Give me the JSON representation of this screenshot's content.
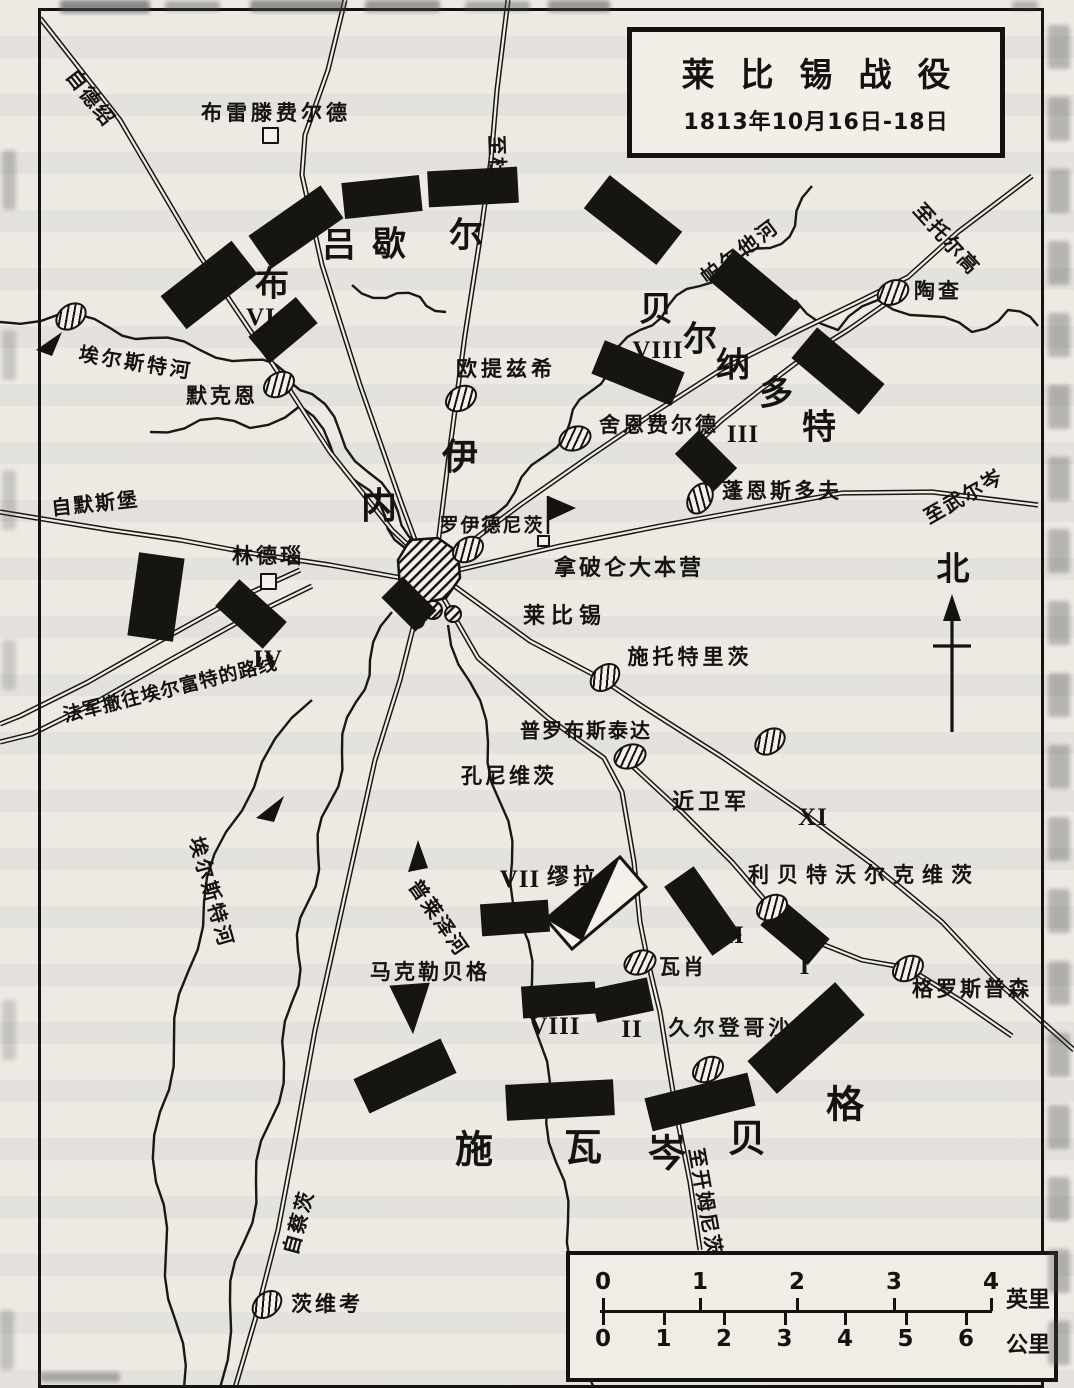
{
  "title": {
    "main": "莱比锡战役",
    "sub": "1813年10月16日-18日"
  },
  "compass": {
    "north_label": "北"
  },
  "scale": {
    "miles": {
      "ticks": [
        "0",
        "1",
        "2",
        "3",
        "4"
      ],
      "unit": "英里"
    },
    "km": {
      "ticks": [
        "0",
        "1",
        "2",
        "3",
        "4",
        "5",
        "6"
      ],
      "unit": "公里"
    }
  },
  "labels": [
    {
      "name": "breitenfeld",
      "text": "布雷滕费尔德",
      "x": 276,
      "y": 112,
      "size": 21,
      "ls": 4,
      "rot": 0
    },
    {
      "name": "eutritzsch",
      "text": "欧提兹希",
      "x": 506,
      "y": 368,
      "size": 21,
      "ls": 4,
      "rot": 0
    },
    {
      "name": "schoenefeld",
      "text": "舍恩费尔德",
      "x": 659,
      "y": 424,
      "size": 21,
      "ls": 3,
      "rot": 0
    },
    {
      "name": "taucha",
      "text": "陶查",
      "x": 938,
      "y": 290,
      "size": 21,
      "ls": 3,
      "rot": 0
    },
    {
      "name": "paunsdorf",
      "text": "蓬恩斯多夫",
      "x": 782,
      "y": 490,
      "size": 21,
      "ls": 3,
      "rot": 0
    },
    {
      "name": "reudnitz",
      "text": "罗伊德尼茨",
      "x": 492,
      "y": 524,
      "size": 19,
      "ls": 2,
      "rot": 0
    },
    {
      "name": "napoleon-hq",
      "text": "拿破仑大本营",
      "x": 629,
      "y": 566,
      "size": 22,
      "ls": 3,
      "rot": 0
    },
    {
      "name": "leipzig",
      "text": "莱比锡",
      "x": 565,
      "y": 614,
      "size": 22,
      "ls": 6,
      "rot": 0
    },
    {
      "name": "stoetteritz",
      "text": "施托特里茨",
      "x": 690,
      "y": 656,
      "size": 21,
      "ls": 4,
      "rot": 0
    },
    {
      "name": "probstheida",
      "text": "普罗布斯泰达",
      "x": 586,
      "y": 729,
      "size": 20,
      "ls": 2,
      "rot": 0
    },
    {
      "name": "connewitz",
      "text": "孔尼维茨",
      "x": 509,
      "y": 775,
      "size": 21,
      "ls": 3,
      "rot": 0
    },
    {
      "name": "guard",
      "text": "近卫军",
      "x": 711,
      "y": 800,
      "size": 22,
      "ls": 4,
      "rot": 0
    },
    {
      "name": "liebertwolkwitz",
      "text": "利贝特沃尔克维茨",
      "x": 864,
      "y": 874,
      "size": 21,
      "ls": 8,
      "rot": 0
    },
    {
      "name": "wachau",
      "text": "瓦肖",
      "x": 683,
      "y": 966,
      "size": 21,
      "ls": 3,
      "rot": 0
    },
    {
      "name": "gueldengossa",
      "text": "久尔登哥沙",
      "x": 731,
      "y": 1027,
      "size": 21,
      "ls": 4,
      "rot": 0
    },
    {
      "name": "grosspoesna",
      "text": "格罗斯普森",
      "x": 972,
      "y": 988,
      "size": 21,
      "ls": 3,
      "rot": 0
    },
    {
      "name": "markkleeberg",
      "text": "马克勒贝格",
      "x": 430,
      "y": 971,
      "size": 21,
      "ls": 3,
      "rot": 0
    },
    {
      "name": "zwenkau",
      "text": "茨维考",
      "x": 327,
      "y": 1303,
      "size": 21,
      "ls": 3,
      "rot": 0
    },
    {
      "name": "lindenau",
      "text": "林德瑙",
      "x": 268,
      "y": 555,
      "size": 21,
      "ls": 3,
      "rot": 0
    },
    {
      "name": "moeckern",
      "text": "默克恩",
      "x": 222,
      "y": 395,
      "size": 21,
      "ls": 3,
      "rot": 0
    },
    {
      "name": "murat",
      "text": "缪拉",
      "x": 573,
      "y": 875,
      "size": 22,
      "ls": 4,
      "rot": 0
    },
    {
      "name": "from-merseburg",
      "text": "自默斯堡",
      "x": 95,
      "y": 502,
      "size": 20,
      "ls": 2,
      "rot": -6
    },
    {
      "name": "retreat-route",
      "text": "法军撤往埃尔富特的路线",
      "x": 170,
      "y": 688,
      "size": 19,
      "ls": 1,
      "rot": -14
    },
    {
      "name": "from-dessau",
      "text": "自德绍",
      "x": 92,
      "y": 97,
      "size": 20,
      "ls": 2,
      "rot": 52
    },
    {
      "name": "to-dueben",
      "text": "至杜本",
      "x": 499,
      "y": 168,
      "size": 20,
      "ls": 2,
      "rot": 88
    },
    {
      "name": "to-torgau",
      "text": "至托尔高",
      "x": 948,
      "y": 238,
      "size": 20,
      "ls": 2,
      "rot": 48
    },
    {
      "name": "to-wurzen",
      "text": "至武尔岑",
      "x": 963,
      "y": 495,
      "size": 20,
      "ls": 2,
      "rot": -30
    },
    {
      "name": "to-chemnitz",
      "text": "至开姆尼茨",
      "x": 707,
      "y": 1202,
      "size": 20,
      "ls": 2,
      "rot": 80
    },
    {
      "name": "from-zeitz",
      "text": "自蔡茨",
      "x": 297,
      "y": 1222,
      "size": 20,
      "ls": 2,
      "rot": -75
    },
    {
      "name": "elster-river-west",
      "text": "埃尔斯特河",
      "x": 136,
      "y": 361,
      "size": 20,
      "ls": 3,
      "rot": 9
    },
    {
      "name": "elster-river-south",
      "text": "埃尔斯特河",
      "x": 213,
      "y": 892,
      "size": 20,
      "ls": 3,
      "rot": 74
    },
    {
      "name": "pleisse-river",
      "text": "普莱泽河",
      "x": 440,
      "y": 917,
      "size": 20,
      "ls": 2,
      "rot": 55
    },
    {
      "name": "parthe-river",
      "text": "帕尔他河",
      "x": 739,
      "y": 250,
      "size": 20,
      "ls": 3,
      "rot": -37
    }
  ],
  "commanders": [
    {
      "name": "bluecher",
      "size": 34,
      "chars": [
        {
          "t": "布",
          "x": 272,
          "y": 281
        },
        {
          "t": "吕",
          "x": 339,
          "y": 242
        },
        {
          "t": "歇",
          "x": 389,
          "y": 241
        },
        {
          "t": "尔",
          "x": 466,
          "y": 232
        }
      ]
    },
    {
      "name": "ney",
      "size": 36,
      "chars": [
        {
          "t": "内",
          "x": 379,
          "y": 503
        },
        {
          "t": "伊",
          "x": 460,
          "y": 454
        }
      ]
    },
    {
      "name": "bernadotte",
      "size": 34,
      "chars": [
        {
          "t": "贝",
          "x": 656,
          "y": 306
        },
        {
          "t": "尔",
          "x": 700,
          "y": 336
        },
        {
          "t": "纳",
          "x": 733,
          "y": 362
        },
        {
          "t": "多",
          "x": 776,
          "y": 390
        },
        {
          "t": "特",
          "x": 819,
          "y": 424
        }
      ]
    },
    {
      "name": "schwarzenberg",
      "size": 38,
      "chars": [
        {
          "t": "施",
          "x": 474,
          "y": 1146
        },
        {
          "t": "瓦",
          "x": 583,
          "y": 1144
        },
        {
          "t": "岑",
          "x": 667,
          "y": 1150
        },
        {
          "t": "贝",
          "x": 747,
          "y": 1135
        },
        {
          "t": "格",
          "x": 845,
          "y": 1101
        }
      ]
    }
  ],
  "corps": [
    {
      "num": "VI",
      "x": 261,
      "y": 318
    },
    {
      "num": "IV",
      "x": 268,
      "y": 660
    },
    {
      "num": "VIII",
      "x": 658,
      "y": 351
    },
    {
      "num": "III",
      "x": 743,
      "y": 435
    },
    {
      "num": "XI",
      "x": 813,
      "y": 818
    },
    {
      "num": "VII",
      "x": 520,
      "y": 880
    },
    {
      "num": "XI",
      "x": 730,
      "y": 936
    },
    {
      "num": "I",
      "x": 805,
      "y": 967
    },
    {
      "num": "VIII",
      "x": 555,
      "y": 1027
    },
    {
      "num": "II",
      "x": 632,
      "y": 1030
    }
  ],
  "units": [
    {
      "x": 296,
      "y": 227,
      "w": 88,
      "h": 40,
      "rot": -35
    },
    {
      "x": 382,
      "y": 197,
      "w": 78,
      "h": 36,
      "rot": -6
    },
    {
      "x": 473,
      "y": 187,
      "w": 90,
      "h": 36,
      "rot": -3
    },
    {
      "x": 209,
      "y": 285,
      "w": 90,
      "h": 42,
      "rot": -38
    },
    {
      "x": 283,
      "y": 330,
      "w": 62,
      "h": 34,
      "rot": -40
    },
    {
      "x": 633,
      "y": 220,
      "w": 92,
      "h": 42,
      "rot": 38
    },
    {
      "x": 755,
      "y": 293,
      "w": 88,
      "h": 40,
      "rot": 40
    },
    {
      "x": 838,
      "y": 371,
      "w": 88,
      "h": 40,
      "rot": 40
    },
    {
      "x": 638,
      "y": 373,
      "w": 86,
      "h": 36,
      "rot": 22
    },
    {
      "x": 706,
      "y": 461,
      "w": 54,
      "h": 34,
      "rot": 45
    },
    {
      "x": 409,
      "y": 604,
      "w": 48,
      "h": 30,
      "rot": 45
    },
    {
      "x": 156,
      "y": 597,
      "w": 46,
      "h": 84,
      "rot": 8
    },
    {
      "x": 251,
      "y": 614,
      "w": 64,
      "h": 36,
      "rot": 42
    },
    {
      "x": 515,
      "y": 918,
      "w": 68,
      "h": 32,
      "rot": -4
    },
    {
      "x": 703,
      "y": 911,
      "w": 84,
      "h": 36,
      "rot": 55
    },
    {
      "x": 795,
      "y": 932,
      "w": 62,
      "h": 34,
      "rot": 40
    },
    {
      "x": 559,
      "y": 1000,
      "w": 74,
      "h": 32,
      "rot": -4
    },
    {
      "x": 622,
      "y": 1000,
      "w": 58,
      "h": 34,
      "rot": -12
    },
    {
      "x": 806,
      "y": 1038,
      "w": 118,
      "h": 44,
      "rot": -42
    },
    {
      "x": 405,
      "y": 1076,
      "w": 96,
      "h": 38,
      "rot": -25
    },
    {
      "x": 560,
      "y": 1100,
      "w": 108,
      "h": 36,
      "rot": -3
    },
    {
      "x": 700,
      "y": 1102,
      "w": 106,
      "h": 34,
      "rot": -14
    },
    {
      "x": 412,
      "y": 1008,
      "w": 44,
      "h": 52,
      "rot": -10,
      "shape": "tri"
    }
  ],
  "towns": [
    {
      "name": "breitenfeld-town-icon",
      "x": 277,
      "y": 138,
      "type": "building"
    },
    {
      "name": "eutritzsch-town-icon",
      "x": 459,
      "y": 397,
      "rot": -30
    },
    {
      "name": "schoenefeld-town-icon",
      "x": 573,
      "y": 437,
      "rot": -20
    },
    {
      "name": "taucha-town-icon",
      "x": 891,
      "y": 291,
      "rot": -25
    },
    {
      "name": "paunsdorf-town-icon",
      "x": 698,
      "y": 497,
      "rot": -60
    },
    {
      "name": "reudnitz-town-icon",
      "x": 466,
      "y": 548,
      "rot": -30
    },
    {
      "name": "stoetteritz-town-icon",
      "x": 603,
      "y": 676,
      "rot": -40
    },
    {
      "name": "probstheida-town-icon",
      "x": 628,
      "y": 755,
      "rot": -20
    },
    {
      "name": "village-icon",
      "x": 768,
      "y": 740,
      "rot": -35
    },
    {
      "name": "liebertwolkwitz-town-icon",
      "x": 770,
      "y": 906,
      "rot": -30
    },
    {
      "name": "wachau-town-icon",
      "x": 638,
      "y": 961,
      "rot": -20
    },
    {
      "name": "gueldengossa-town-icon",
      "x": 706,
      "y": 1068,
      "rot": -30
    },
    {
      "name": "grosspoesna-town-icon",
      "x": 906,
      "y": 967,
      "rot": -30
    },
    {
      "name": "zwenkau-town-icon",
      "x": 265,
      "y": 1303,
      "rot": -40
    },
    {
      "name": "moeckern-town-icon",
      "x": 277,
      "y": 383,
      "rot": -30
    },
    {
      "name": "elster-village-icon",
      "x": 69,
      "y": 315,
      "rot": -35
    },
    {
      "name": "lindenau-town-icon",
      "x": 275,
      "y": 584,
      "type": "building"
    }
  ]
}
